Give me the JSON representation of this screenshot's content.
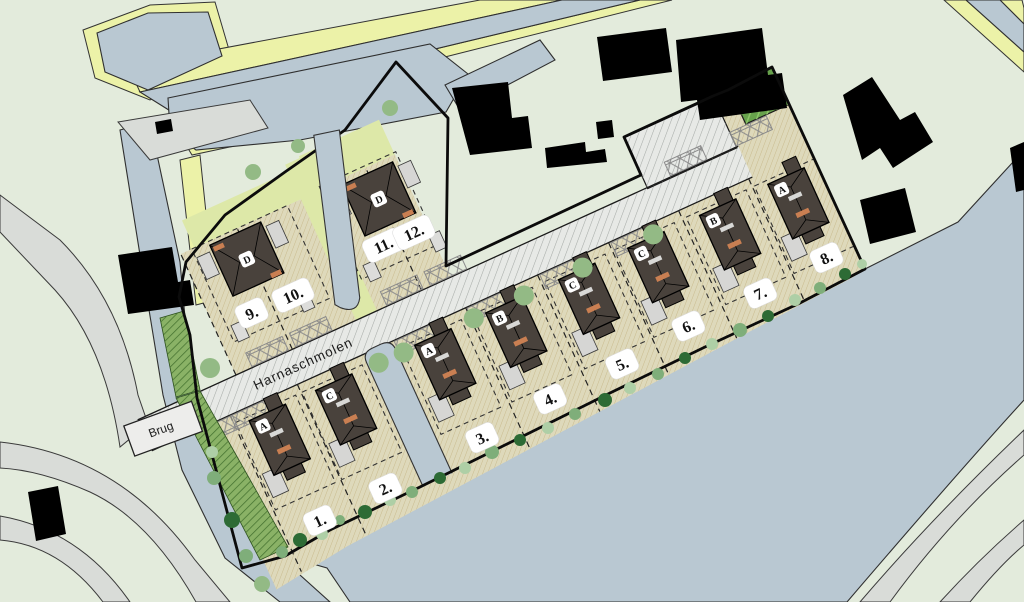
{
  "labels": {
    "street": "Harnaschmolen",
    "bridge": "Brug"
  },
  "lots": [
    {
      "label": "1.",
      "house_type": "A"
    },
    {
      "label": "2.",
      "house_type": "C"
    },
    {
      "label": "3.",
      "house_type": "A"
    },
    {
      "label": "4.",
      "house_type": "B"
    },
    {
      "label": "5.",
      "house_type": "C"
    },
    {
      "label": "6.",
      "house_type": "C"
    },
    {
      "label": "7.",
      "house_type": "B"
    },
    {
      "label": "8.",
      "house_type": "A"
    },
    {
      "label": "9.",
      "house_type": "D"
    },
    {
      "label": "10.",
      "house_type": "D"
    },
    {
      "label": "11.",
      "house_type": "D"
    },
    {
      "label": "12.",
      "house_type": "D"
    }
  ],
  "buildings_north": [
    {
      "lots": "9-10",
      "house_type": "D"
    },
    {
      "lots": "11-12",
      "house_type": "D"
    }
  ],
  "colors": {
    "water": "#b9c8d2",
    "land": "#e3ebdc",
    "parcel": "#ded9bb",
    "quay": "#ecf2a8",
    "road_gray": "#d9dcd8",
    "road_surface": "#e7e9e6",
    "house": "#49423c",
    "shed": "#d6d6d4",
    "accent_orange": "#c97f52",
    "green_strip": "#8ab266",
    "tree_dark": "#2d6b35",
    "tree_mid": "#7fae7a",
    "tree_light": "#aecfa6",
    "tree_road": "#93ba85",
    "existing_building": "#000000",
    "badge_bg": "#ffffff",
    "badge_text": "#111111"
  }
}
